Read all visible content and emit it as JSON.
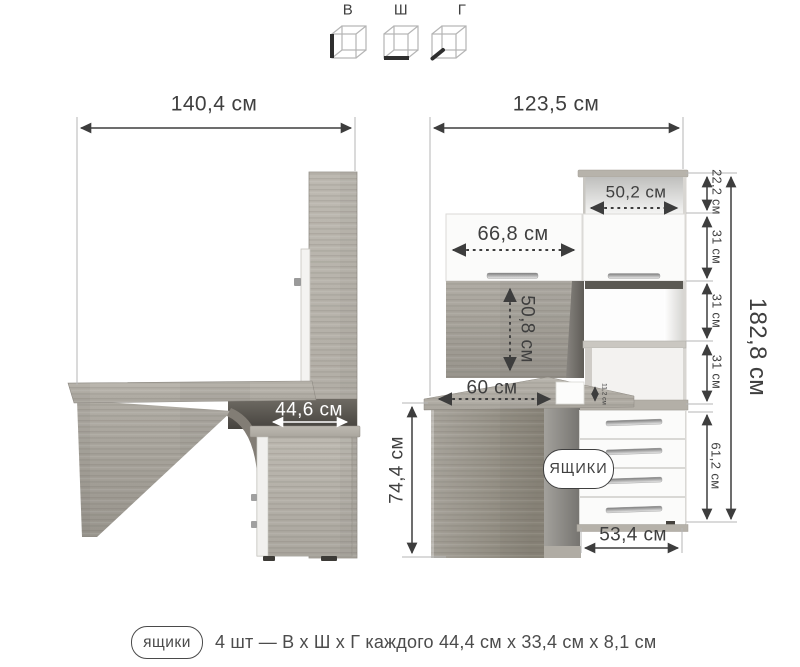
{
  "legend": {
    "height_label": "В",
    "width_label": "Ш",
    "depth_label": "Г"
  },
  "left_view": {
    "total_width": "140,4 см",
    "cabinet_depth": "44,6 см"
  },
  "right_view": {
    "total_width": "123,5 см",
    "top_shelf_width": "50,2 см",
    "door_width": "66,8 см",
    "back_panel_height": "50,8 см",
    "desktop_depth": "60 см",
    "desktop_offset": "11,2 см",
    "height_segments": [
      "22,2 см",
      "31 см",
      "31 см",
      "31 см"
    ],
    "total_height": "182,8 см",
    "desk_height": "74,4 см",
    "drawer_unit_height": "61,2 см",
    "drawer_unit_width": "53,4 см",
    "drawers_badge": "ЯЩИКИ"
  },
  "footer": {
    "badge": "ящики",
    "description": "4 шт — В х Ш х Г каждого 44,4 см х 33,4 см х 8,1 см"
  }
}
